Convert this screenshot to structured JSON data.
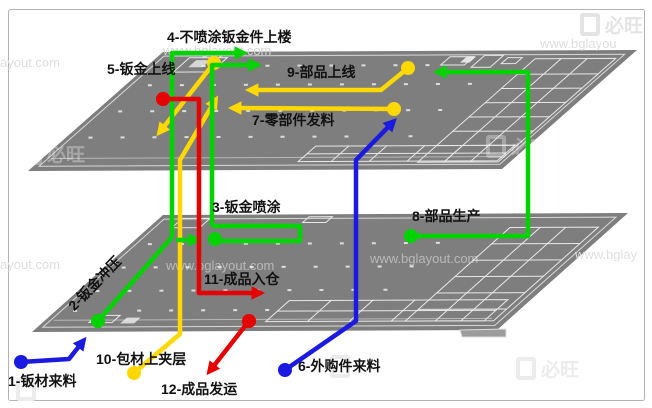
{
  "diagram": {
    "flows": [
      {
        "num": "1",
        "label": "1-钣材来料",
        "color_name": "blue",
        "color": "#1a1ae0"
      },
      {
        "num": "2",
        "label": "2-钣金冲压",
        "color_name": "green",
        "color": "#00d300"
      },
      {
        "num": "3",
        "label": "3-钣金喷涂",
        "color_name": "green",
        "color": "#00d300"
      },
      {
        "num": "4",
        "label": "4-不喷涂钣金件上楼",
        "color_name": "green",
        "color": "#00d300"
      },
      {
        "num": "5",
        "label": "5-钣金上线",
        "color_name": "green",
        "color": "#00d300"
      },
      {
        "num": "6",
        "label": "6-外购件来料",
        "color_name": "blue",
        "color": "#1a1ae0"
      },
      {
        "num": "7",
        "label": "7-零部件发料",
        "color_name": "yellow",
        "color": "#ffd800"
      },
      {
        "num": "8",
        "label": "8-部品生产",
        "color_name": "green",
        "color": "#00d300"
      },
      {
        "num": "9",
        "label": "9-部品上线",
        "color_name": "yellow",
        "color": "#ffd800"
      },
      {
        "num": "10",
        "label": "10-包材上夹层",
        "color_name": "yellow",
        "color": "#ffd800"
      },
      {
        "num": "11",
        "label": "11-成品入仓",
        "color_name": "red",
        "color": "#e60000"
      },
      {
        "num": "12",
        "label": "12-成品发运",
        "color_name": "red",
        "color": "#e60000"
      }
    ],
    "colors": {
      "green": "#00d300",
      "yellow": "#ffd800",
      "red": "#e60000",
      "blue": "#1a1ae0",
      "floor_fill": "#7e7e7e",
      "floor_lines": "#e8e8e8",
      "frame_border": "#b3b3b3",
      "label_text": "#111111"
    },
    "watermarks": {
      "partial_url_top_left": "ayout.com",
      "url_over_upper_floor": "www.bglayout.com",
      "brand_top_right": "必旺",
      "url_top_right": "www.bglayou",
      "partial_url_mid_left": "ayout.com",
      "url_over_lower_floor_1": "www.bglayout.com",
      "url_over_lower_floor_2": "www.bglayout.com",
      "url_over_lower_floor_3": "www.bglay",
      "brand_on_upper_floor": "必旺",
      "brand_bottom_right": "必旺"
    }
  }
}
